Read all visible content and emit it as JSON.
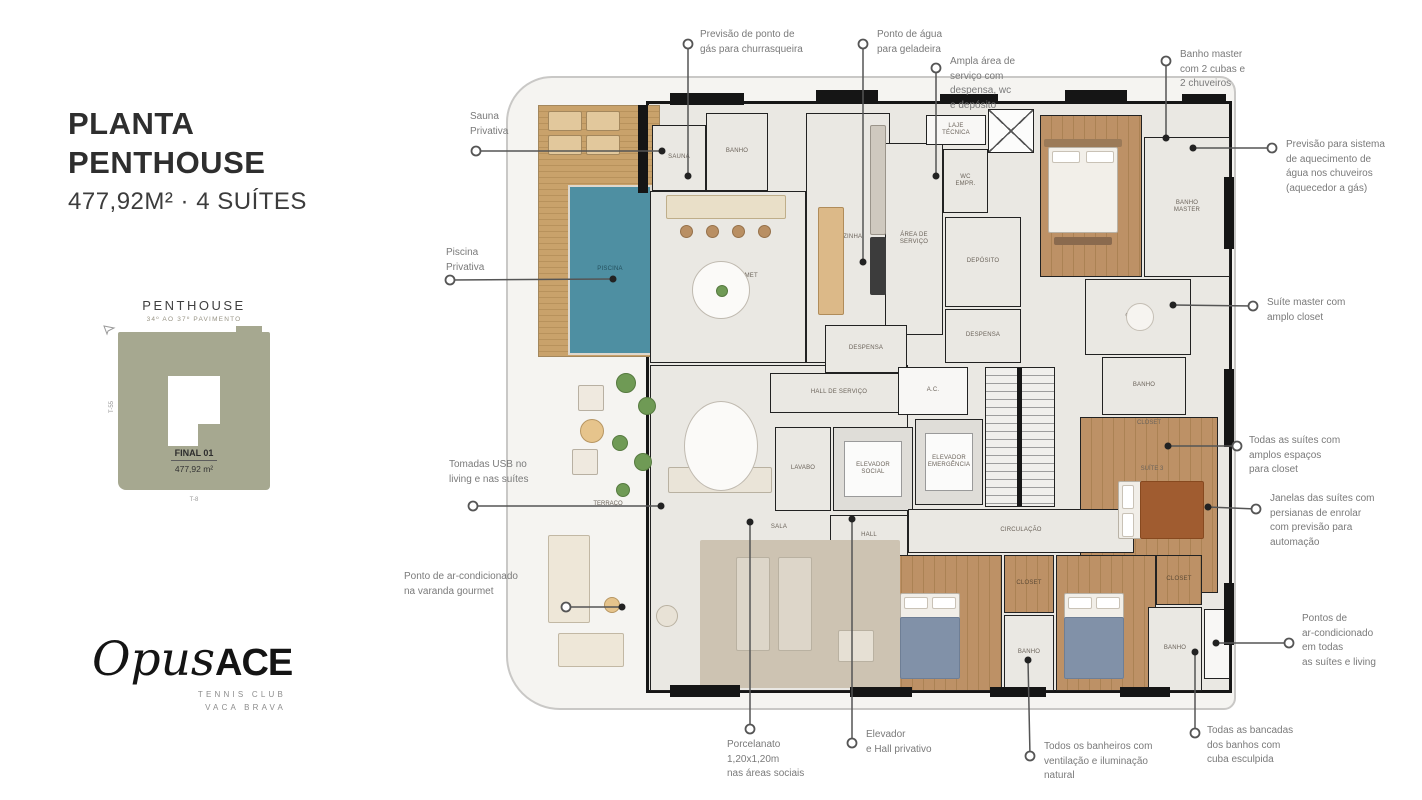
{
  "panel": {
    "title_line1": "PLANTA",
    "title_line2": "PENTHOUSE",
    "subtitle": "477,92M² · 4 SUÍTES",
    "siteplan": {
      "heading": "PENTHOUSE",
      "subheading": "34º AO 37º PAVIMENTO",
      "unit_label": "FINAL 01",
      "unit_area": "477,92 m²",
      "axis_left": "T-55",
      "axis_bottom": "T-8"
    },
    "logo": {
      "script": "Opus",
      "bold": "ACE",
      "sub1": "TENNIS CLUB",
      "sub2": "VACA BRAVA"
    }
  },
  "colors": {
    "wall": "#161616",
    "tile": "#eae8e3",
    "wood": "#bd9166",
    "deck": "#c9a26b",
    "pool": "#4e8fa2",
    "leader": "#555555",
    "callout_text": "#7a7a7a",
    "siteplan_block": "#a6a890"
  },
  "floorplan": {
    "rooms": [
      {
        "id": "deck",
        "label": "",
        "floor": "deck",
        "x": 18,
        "y": 20,
        "w": 122,
        "h": 252
      },
      {
        "id": "pool",
        "label": "PISCINA",
        "floor": "pool",
        "x": 48,
        "y": 100,
        "w": 84,
        "h": 170
      },
      {
        "id": "sala",
        "label": "SALA",
        "floor": "tile",
        "x": 130,
        "y": 280,
        "w": 258,
        "h": 326
      },
      {
        "id": "espaco-gourmet",
        "label": "ESPAÇO GOURMET",
        "floor": "tile",
        "x": 130,
        "y": 106,
        "w": 156,
        "h": 172
      },
      {
        "id": "cozinha",
        "label": "COZINHA",
        "floor": "tile",
        "x": 286,
        "y": 28,
        "w": 84,
        "h": 250
      },
      {
        "id": "sauna",
        "label": "SAUNA",
        "floor": "tile",
        "x": 132,
        "y": 40,
        "w": 54,
        "h": 66
      },
      {
        "id": "banho-terraco",
        "label": "BANHO",
        "floor": "tile",
        "x": 186,
        "y": 28,
        "w": 62,
        "h": 78
      },
      {
        "id": "area-servico",
        "label": "ÁREA DE\nSERVIÇO",
        "floor": "tile",
        "x": 365,
        "y": 58,
        "w": 58,
        "h": 192
      },
      {
        "id": "laje-tecnica",
        "label": "LAJE\nTÉCNICA",
        "floor": "white",
        "x": 406,
        "y": 30,
        "w": 60,
        "h": 30
      },
      {
        "id": "elevador-servico",
        "label": "",
        "floor": "shaft",
        "x": 468,
        "y": 24,
        "w": 46,
        "h": 44
      },
      {
        "id": "wc-empregada",
        "label": "WC\nEMPR.",
        "floor": "tile",
        "x": 423,
        "y": 64,
        "w": 45,
        "h": 64
      },
      {
        "id": "deposito",
        "label": "DEPÓSITO",
        "floor": "tile",
        "x": 425,
        "y": 132,
        "w": 76,
        "h": 90
      },
      {
        "id": "despensa-servico",
        "label": "DESPENSA",
        "floor": "tile",
        "x": 425,
        "y": 224,
        "w": 76,
        "h": 54
      },
      {
        "id": "suite-master",
        "label": "SUÍTE\nMASTER",
        "floor": "wood",
        "x": 520,
        "y": 30,
        "w": 102,
        "h": 162
      },
      {
        "id": "banho-master",
        "label": "BANHO\nMASTER",
        "floor": "tile",
        "x": 624,
        "y": 52,
        "w": 86,
        "h": 140
      },
      {
        "id": "closet-master",
        "label": "CLOSET",
        "floor": "tile",
        "x": 565,
        "y": 194,
        "w": 106,
        "h": 76
      },
      {
        "id": "banho-suite3",
        "label": "BANHO",
        "floor": "tile",
        "x": 582,
        "y": 272,
        "w": 84,
        "h": 58
      },
      {
        "id": "suite3",
        "label": "",
        "floor": "wood",
        "x": 560,
        "y": 332,
        "w": 138,
        "h": 176
      },
      {
        "id": "despensa-social",
        "label": "DESPENSA",
        "floor": "tile",
        "x": 305,
        "y": 240,
        "w": 82,
        "h": 48
      },
      {
        "id": "hall-servico",
        "label": "HALL DE SERVIÇO",
        "floor": "tile",
        "x": 250,
        "y": 288,
        "w": 138,
        "h": 40
      },
      {
        "id": "ac",
        "label": "A.C.",
        "floor": "white",
        "x": 378,
        "y": 282,
        "w": 70,
        "h": 48
      },
      {
        "id": "stairs",
        "label": "",
        "floor": "stairs",
        "x": 465,
        "y": 282,
        "w": 70,
        "h": 140
      },
      {
        "id": "lavabo",
        "label": "LAVABO",
        "floor": "tile",
        "x": 255,
        "y": 342,
        "w": 56,
        "h": 84
      },
      {
        "id": "elevador-social",
        "label": "ELEVADOR\nSOCIAL",
        "floor": "shaft2",
        "x": 313,
        "y": 342,
        "w": 80,
        "h": 84
      },
      {
        "id": "elevador-emergencia",
        "label": "ELEVADOR\nEMERGÊNCIA",
        "floor": "shaft2",
        "x": 395,
        "y": 334,
        "w": 68,
        "h": 86
      },
      {
        "id": "hall-privativo",
        "label": "HALL",
        "floor": "tile",
        "x": 310,
        "y": 430,
        "w": 78,
        "h": 42
      },
      {
        "id": "circulacao",
        "label": "CIRCULAÇÃO",
        "floor": "tile",
        "x": 388,
        "y": 424,
        "w": 226,
        "h": 44
      },
      {
        "id": "suite1",
        "label": "SUÍTE 1",
        "floor": "wood",
        "x": 370,
        "y": 470,
        "w": 112,
        "h": 136
      },
      {
        "id": "closet-suite1",
        "label": "CLOSET",
        "floor": "wood",
        "x": 484,
        "y": 470,
        "w": 50,
        "h": 58
      },
      {
        "id": "banho-suite1",
        "label": "BANHO",
        "floor": "tile",
        "x": 484,
        "y": 530,
        "w": 50,
        "h": 76
      },
      {
        "id": "suite2",
        "label": "SUÍTE 2",
        "floor": "wood",
        "x": 536,
        "y": 470,
        "w": 100,
        "h": 136
      },
      {
        "id": "closet-suite2",
        "label": "CLOSET",
        "floor": "wood",
        "x": 636,
        "y": 470,
        "w": 46,
        "h": 50
      },
      {
        "id": "banho-suite2",
        "label": "BANHO",
        "floor": "tile",
        "x": 628,
        "y": 522,
        "w": 54,
        "h": 84
      },
      {
        "id": "ac-unit",
        "label": "",
        "floor": "white",
        "x": 684,
        "y": 524,
        "w": 26,
        "h": 70
      }
    ],
    "labels": [
      {
        "text": "TERRAÇO",
        "x": 88,
        "y": 419
      },
      {
        "text": "CLOSET",
        "x": 629,
        "y": 338
      },
      {
        "text": "SUÍTE 3",
        "x": 632,
        "y": 384
      }
    ]
  },
  "callouts": [
    {
      "id": "sauna-privativa",
      "text": "Sauna\nPrivativa",
      "x": 470,
      "y": 110,
      "cx": 476,
      "cy": 151,
      "tx": 662,
      "ty": 151
    },
    {
      "id": "gas-churrasqueira",
      "text": "Previsão de ponto de\ngás para churrasqueira",
      "x": 700,
      "y": 28,
      "cx": 688,
      "cy": 44,
      "tx": 688,
      "ty": 176
    },
    {
      "id": "agua-geladeira",
      "text": "Ponto de água\npara geladeira",
      "x": 877,
      "y": 28,
      "cx": 863,
      "cy": 44,
      "tx": 863,
      "ty": 262
    },
    {
      "id": "area-servico",
      "text": "Ampla área de\nserviço com\ndespensa, wc\ne depósito",
      "x": 950,
      "y": 55,
      "cx": 936,
      "cy": 68,
      "tx": 936,
      "ty": 176
    },
    {
      "id": "banho-master",
      "text": "Banho master\ncom 2 cubas e\n2 chuveiros",
      "x": 1180,
      "y": 48,
      "cx": 1166,
      "cy": 61,
      "tx": 1166,
      "ty": 138
    },
    {
      "id": "aquecimento",
      "text": "Previsão para sistema\nde aquecimento de\nágua nos chuveiros\n(aquecedor a gás)",
      "x": 1286,
      "y": 138,
      "cx": 1272,
      "cy": 148,
      "tx": 1193,
      "ty": 148
    },
    {
      "id": "suite-master-closet",
      "text": "Suíte master com\namplo closet",
      "x": 1267,
      "y": 296,
      "cx": 1253,
      "cy": 306,
      "tx": 1173,
      "ty": 305
    },
    {
      "id": "suites-closet",
      "text": "Todas as suítes com\namplos espaços\npara closet",
      "x": 1249,
      "y": 434,
      "cx": 1237,
      "cy": 446,
      "tx": 1168,
      "ty": 446
    },
    {
      "id": "janelas-persianas",
      "text": "Janelas das suítes com\npersianas de enrolar\ncom previsão para\nautomação",
      "x": 1270,
      "y": 492,
      "cx": 1256,
      "cy": 509,
      "tx": 1208,
      "ty": 507
    },
    {
      "id": "pontos-ar",
      "text": "Pontos de\nar-condicionado\nem todas\nas suítes e living",
      "x": 1302,
      "y": 612,
      "cx": 1289,
      "cy": 643,
      "tx": 1216,
      "ty": 643
    },
    {
      "id": "bancadas-cuba",
      "text": "Todas as bancadas\ndos banhos com\ncuba esculpida",
      "x": 1207,
      "y": 724,
      "cx": 1195,
      "cy": 733,
      "tx": 1195,
      "ty": 652
    },
    {
      "id": "porcelanato",
      "text": "Porcelanato\n1,20x1,20m\nnas áreas sociais",
      "x": 727,
      "y": 738,
      "cx": 750,
      "cy": 729,
      "tx": 750,
      "ty": 522
    },
    {
      "id": "elevador-hall",
      "text": "Elevador\ne Hall privativo",
      "x": 866,
      "y": 728,
      "cx": 852,
      "cy": 743,
      "tx": 852,
      "ty": 519
    },
    {
      "id": "banheiros-ventilacao",
      "text": "Todos os banheiros com\nventilação e iluminação\nnatural",
      "x": 1044,
      "y": 740,
      "cx": 1030,
      "cy": 756,
      "tx": 1028,
      "ty": 660
    },
    {
      "id": "piscina-privativa",
      "text": "Piscina\nPrivativa",
      "x": 446,
      "y": 246,
      "cx": 450,
      "cy": 280,
      "tx": 613,
      "ty": 279
    },
    {
      "id": "tomadas-usb",
      "text": "Tomadas USB no\nliving e nas suítes",
      "x": 449,
      "y": 458,
      "cx": 473,
      "cy": 506,
      "tx": 661,
      "ty": 506
    },
    {
      "id": "ar-varanda",
      "text": "Ponto de ar-condicionado\nna varanda gourmet",
      "x": 404,
      "y": 570,
      "cx": 566,
      "cy": 607,
      "tx": 622,
      "ty": 607
    }
  ]
}
